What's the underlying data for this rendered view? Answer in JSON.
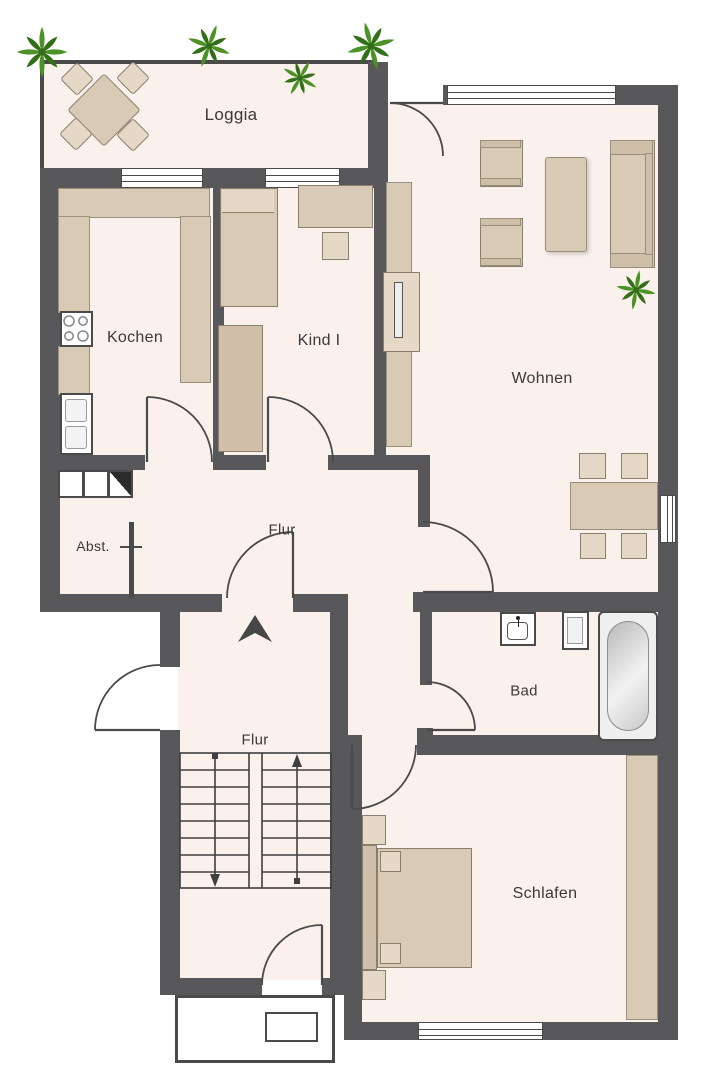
{
  "colors": {
    "wall": "#58585a",
    "floor": "#faf0ec",
    "outline": "#4a4a4a",
    "furniture": "#d9cab5",
    "furniture_light": "#e5d8c6",
    "furniture_dark": "#cfbfa8",
    "plant_green": "#4c9226",
    "plant_green_dark": "#336f18",
    "label": "#3a3a3a"
  },
  "rooms": {
    "loggia": {
      "label": "Loggia"
    },
    "kitchen": {
      "label": "Kochen"
    },
    "child_room": {
      "label": "Kind I"
    },
    "living_room": {
      "label": "Wohnen"
    },
    "hall_upper": {
      "label": "Flur"
    },
    "storage": {
      "label": "Abst."
    },
    "hall_lower": {
      "label": "Flur"
    },
    "bathroom": {
      "label": "Bad"
    },
    "bedroom": {
      "label": "Schlafen"
    }
  }
}
